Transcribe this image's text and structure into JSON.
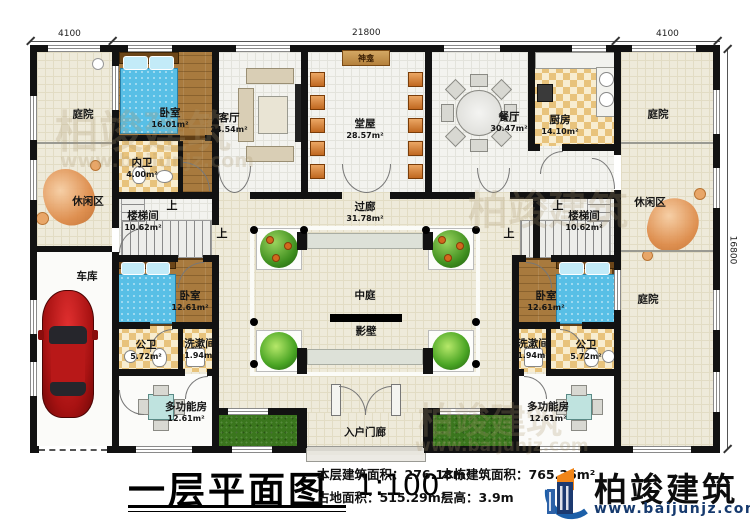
{
  "plan": {
    "dimensions": {
      "top_left": "4100",
      "top_center": "21800",
      "top_right": "4100",
      "right_side": "16800"
    },
    "stair_up_label": "上",
    "rooms": {
      "courtyard_top_left": {
        "name": "庭院"
      },
      "leisure_left": {
        "name": "休闲区"
      },
      "garage": {
        "name": "车库"
      },
      "bedroom_top_left": {
        "name": "卧室",
        "area": "16.01m²"
      },
      "inner_bath": {
        "name": "内卫",
        "area": "4.00m²"
      },
      "living_room": {
        "name": "客厅",
        "area": "24.54m²"
      },
      "main_hall": {
        "name": "堂屋",
        "area": "28.57m²"
      },
      "shrine": {
        "name": "神龛"
      },
      "dining_room": {
        "name": "餐厅",
        "area": "30.47m²"
      },
      "kitchen": {
        "name": "厨房",
        "area": "14.10m²"
      },
      "courtyard_top_right": {
        "name": "庭院"
      },
      "leisure_right": {
        "name": "休闲区"
      },
      "courtyard_bottom_right": {
        "name": "庭院"
      },
      "stairwell_left": {
        "name": "楼梯间",
        "area": "10.62m²"
      },
      "stairwell_right": {
        "name": "楼梯间",
        "area": "10.62m²"
      },
      "corridor": {
        "name": "过廊",
        "area": "31.78m²"
      },
      "atrium": {
        "name": "中庭"
      },
      "screen_wall": {
        "name": "影壁"
      },
      "bedroom_bottom_left": {
        "name": "卧室",
        "area": "12.61m²"
      },
      "public_bath_left": {
        "name": "公卫",
        "area": "5.72m²"
      },
      "wash_room_left": {
        "name": "洗漱间",
        "area": "1.94m²"
      },
      "multi_room_left": {
        "name": "多功能房",
        "area": "12.61m²"
      },
      "bedroom_bottom_right": {
        "name": "卧室",
        "area": "12.61m²"
      },
      "wash_room_right": {
        "name": "洗漱间",
        "area": "1.94m²"
      },
      "public_bath_right": {
        "name": "公卫",
        "area": "5.72m²"
      },
      "multi_room_right": {
        "name": "多功能房",
        "area": "12.61m²"
      },
      "entry_porch": {
        "name": "入户门廊"
      }
    }
  },
  "title_block": {
    "title": "一层平面图",
    "scale": "1:100",
    "stats": [
      {
        "label": "本层建筑面积：",
        "value": "276.18m²"
      },
      {
        "label": "占地面积：",
        "value": "515.29m²"
      },
      {
        "label": "本栋建筑面积：",
        "value": "765.36m²"
      },
      {
        "label": "层高：",
        "value": "3.9m"
      }
    ]
  },
  "brand": {
    "name": "柏竣建筑",
    "website": "www.baijunjz.com"
  },
  "watermark": {
    "name": "柏竣建筑",
    "website": "www.baijunjz.com"
  },
  "colors": {
    "wall": "#121212",
    "wood_floor": "#a87a3e",
    "bed_blue": "#58bfe6",
    "courtyard_beige": "#eeeada",
    "grass_green": "#3a761d",
    "brand_navy": "#1c3a70",
    "brand_orange": "#f08519"
  }
}
